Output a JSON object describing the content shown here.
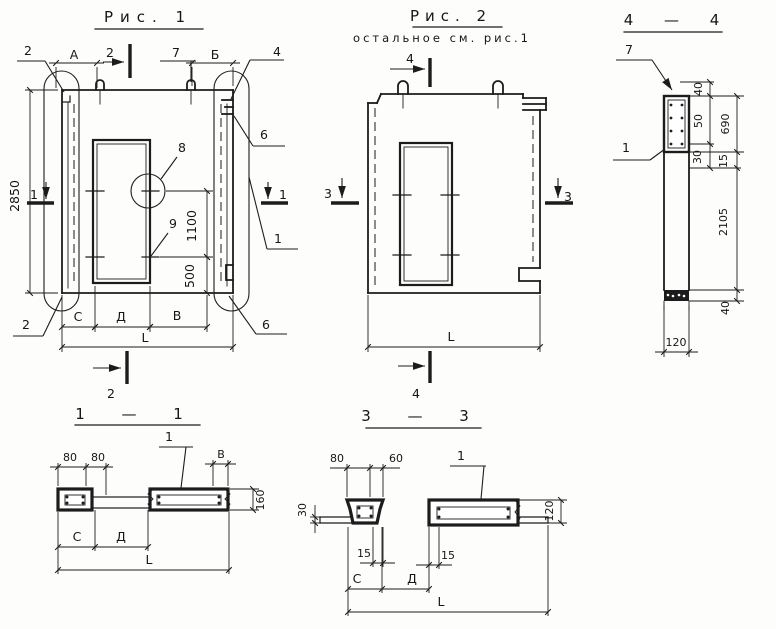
{
  "figure1": {
    "title": "Рис. 1",
    "section_markers": {
      "s1_left": "1",
      "s1_right": "1",
      "s2_top": "2",
      "s2_bottom": "2"
    },
    "callouts": {
      "edge_top_left": "2",
      "lifting_loop": "7",
      "edge_top_right": "4",
      "rebate_top_right": "6",
      "panel_side": "1",
      "detail_circle": "8",
      "tie_bar": "9",
      "rebate_bottom_right": "6",
      "edge_bottom_left": "2"
    },
    "dimensions": {
      "a": "А",
      "b": "Б",
      "height": "2850",
      "tie_spacing": "1100",
      "tie_bottom": "500",
      "c": "С",
      "d": "Д",
      "v": "В",
      "length": "L"
    }
  },
  "figure2": {
    "title": "Рис. 2",
    "subtitle": "остальное см. рис.1",
    "section_markers": {
      "s3_left": "3",
      "s3_right": "3",
      "s4_top": "4",
      "s4_bottom": "4"
    },
    "dimensions": {
      "length": "L"
    }
  },
  "section_4_4": {
    "title": "4 — 4",
    "callouts": {
      "embed_part": "7",
      "panel": "1"
    },
    "dimensions": {
      "lip": "40",
      "recess": "50",
      "upper_zone": "690",
      "ledge": "30",
      "inset": "15",
      "shaft": "2105",
      "bottom_block": "40",
      "thickness": "120"
    }
  },
  "section_1_1": {
    "title": "1 — 1",
    "callouts": {
      "panel": "1"
    },
    "dimensions": {
      "rib_a": "80",
      "rib_b": "80",
      "v": "В",
      "height": "160",
      "c": "С",
      "d": "Д",
      "length": "L"
    }
  },
  "section_3_3": {
    "title": "3 — 3",
    "callouts": {
      "panel": "1"
    },
    "dimensions": {
      "rib": "80",
      "gap": "60",
      "slab": "30",
      "height": "120",
      "inset_a": "15",
      "inset_b": "15",
      "c": "С",
      "d": "Д",
      "length": "L"
    }
  }
}
